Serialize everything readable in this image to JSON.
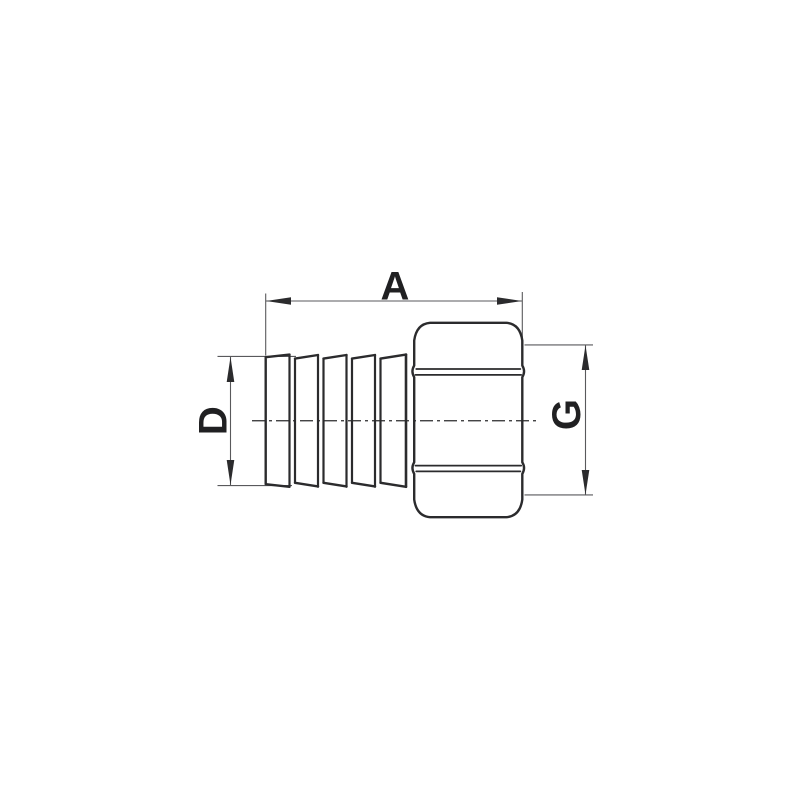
{
  "drawing": {
    "kind": "technical-dimension-drawing",
    "subject": "hose-barb-to-female-hex-thread-adapter",
    "labels": {
      "overall_length": "A",
      "barb_diameter": "D",
      "thread_diameter": "G"
    },
    "colors": {
      "background": "#ffffff",
      "object_line": "#2b2b2d",
      "dimension_line": "#59595c",
      "label_text": "#202022"
    },
    "parts": [
      "barbed-hose-tail",
      "hex-nut-body",
      "centerline"
    ]
  }
}
